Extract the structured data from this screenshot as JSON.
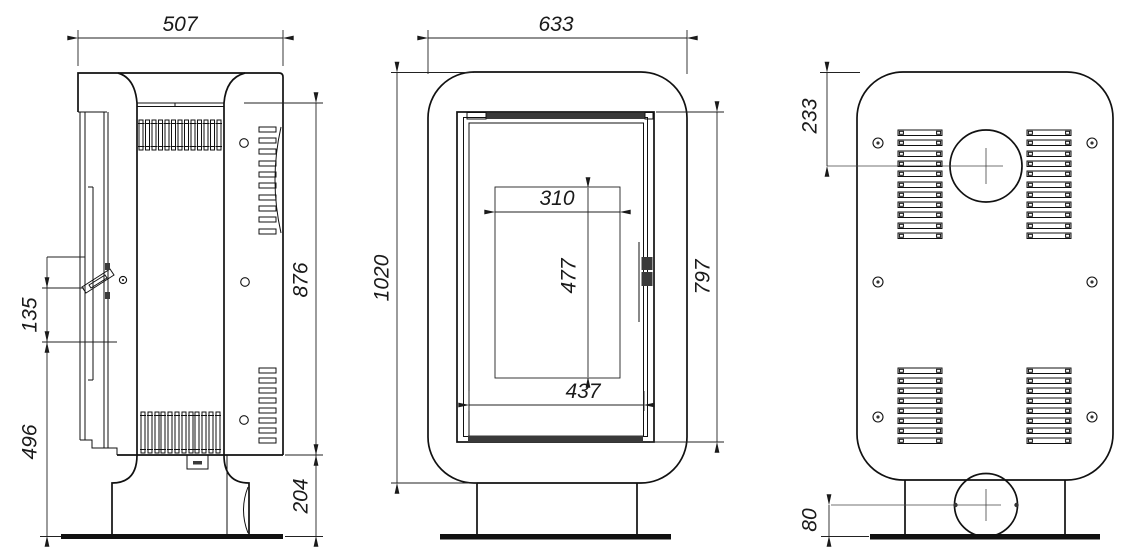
{
  "drawing": {
    "type": "technical-drawing-3-views",
    "subject": "stove",
    "colors": {
      "line": "#1a1a1a",
      "dark_fill": "#3a3a3a",
      "background": "#ffffff"
    },
    "views": {
      "side": {
        "dims": {
          "width": "507",
          "handle_span": "135",
          "front_height": "496",
          "body_height": "876",
          "base_height": "204"
        }
      },
      "front": {
        "dims": {
          "width": "633",
          "total_height": "1020",
          "glass_width": "310",
          "glass_height": "477",
          "door_width": "437",
          "door_height": "797"
        }
      },
      "back": {
        "dims": {
          "flue_center_offset": "233",
          "inlet_center_height": "80"
        }
      }
    }
  }
}
